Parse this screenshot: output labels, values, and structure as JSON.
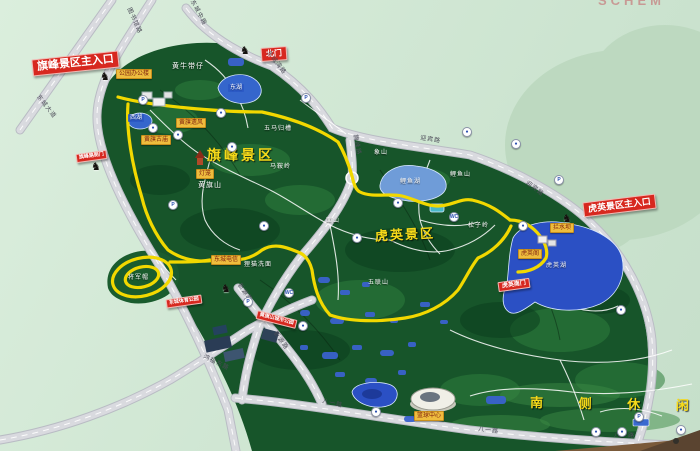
{
  "photo": {
    "top_edge_fragment": "SCHEM"
  },
  "entrances": {
    "qifeng_main": "旗峰景区主入口",
    "north_gate": "北门",
    "qifeng_side": "旗峰路侧门",
    "huying_main": "虎英景区主入口",
    "huying_south": "虎英南门",
    "sports_park": "东城体育公园",
    "city_park": "黄旗山城市公园"
  },
  "area_titles": {
    "qifeng": "旗峰景区",
    "huying": "虎英景区",
    "south_leisure": "南 侧 休 闲 区"
  },
  "mountains": [
    {
      "text": "黄牛带仔"
    },
    {
      "text": "五马归槽"
    },
    {
      "text": "马鞍岭"
    },
    {
      "text": "黄旗山"
    },
    {
      "text": "象山"
    },
    {
      "text": "鲤鱼山"
    },
    {
      "text": "面山"
    },
    {
      "text": "松子岭"
    },
    {
      "text": "狸猫洗面"
    },
    {
      "text": "五联山"
    },
    {
      "text": "将军帽"
    }
  ],
  "lakes": [
    {
      "text": "东湖"
    },
    {
      "text": "西湖"
    },
    {
      "text": "鲤鱼湖"
    },
    {
      "text": "虎英湖"
    }
  ],
  "attractions": [
    {
      "text": "公园办公楼"
    },
    {
      "text": "黄旗遗风"
    },
    {
      "text": "黄旗古庙"
    },
    {
      "text": "灯笼"
    },
    {
      "text": "东城电信"
    },
    {
      "text": "虎英阁"
    },
    {
      "text": "拦水坝"
    },
    {
      "text": "篮球中心"
    }
  ],
  "roads": {
    "tushuguan": "图书馆路",
    "dongcheng_dadao": "东城大道",
    "dongcheng_zhonglu": "东城中路",
    "dongcheng_wanlu": "东城湾路",
    "yingbin": "迎宾路",
    "qifeng_lu": "旗峰路",
    "xinyuan": "新源路",
    "hongfu_donglu": "鸿福东路",
    "bayi": "八一路"
  },
  "icons": {
    "parking": "P",
    "toilet": "WC",
    "poi": "●",
    "gate": "♞"
  },
  "colors": {
    "park_green": "#17552a",
    "route_yellow": "#f2d800",
    "sign_red": "#d7281f",
    "lake_blue": "#2b50c4",
    "road_gray": "#d9dadf",
    "background_green": "#d2e8d5"
  }
}
